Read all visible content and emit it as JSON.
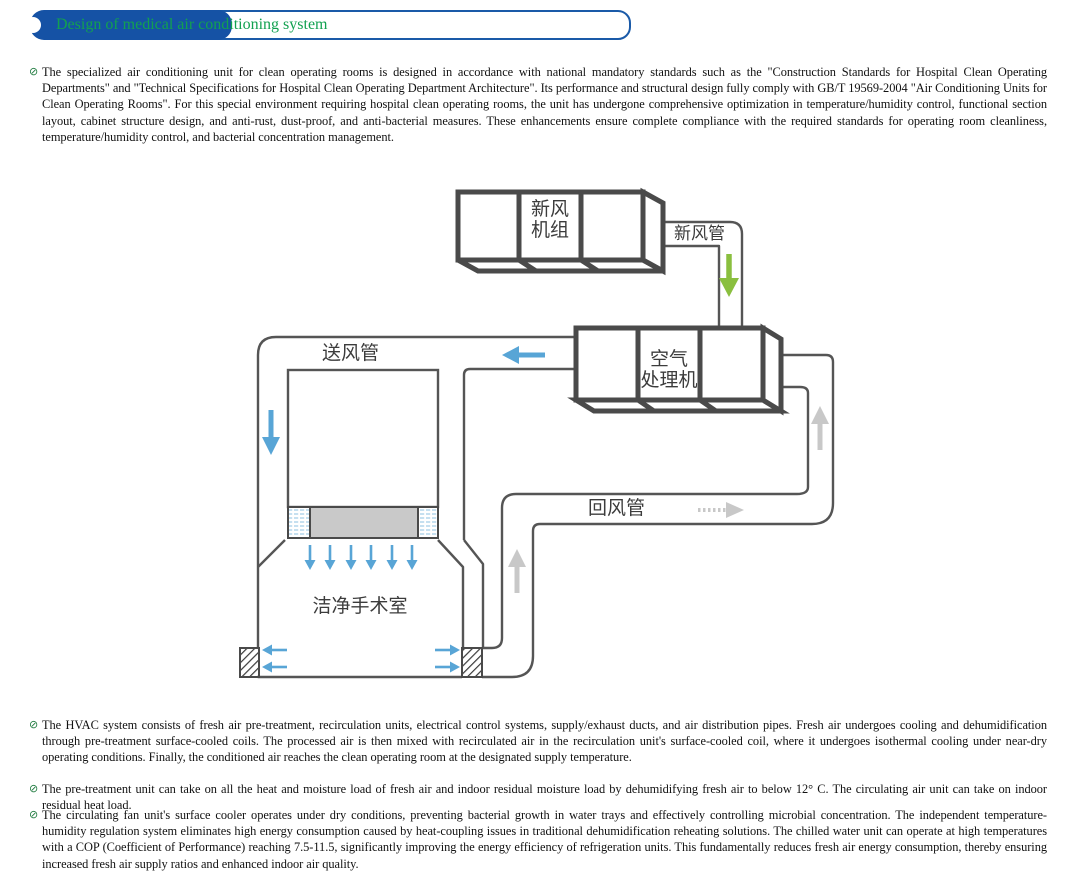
{
  "banner": {
    "title": "Design of medical air conditioning system"
  },
  "bullet_glyph": "⊘",
  "paragraphs": [
    {
      "text": "The specialized air conditioning unit for clean operating rooms is designed in accordance with national mandatory standards such as the \"Construction Standards for Hospital Clean Operating Departments\" and \"Technical Specifications for Hospital Clean Operating Department Architecture\". Its performance and structural design fully comply with GB/T 19569-2004 \"Air Conditioning Units for Clean Operating Rooms\". For this special environment requiring hospital clean operating rooms, the unit has undergone comprehensive optimization in temperature/humidity control, functional section layout, cabinet structure design, and anti-rust, dust-proof, and anti-bacterial measures. These enhancements ensure complete compliance with the required standards for operating room cleanliness, temperature/humidity control, and bacterial concentration management."
    },
    {
      "text": "The HVAC system consists of fresh air pre-treatment, recirculation units, electrical control systems, supply/exhaust ducts, and air distribution pipes. Fresh air undergoes cooling and dehumidification through pre-treatment surface-cooled coils. The processed air is then mixed with recirculated air in the recirculation unit's surface-cooled coil, where it undergoes isothermal cooling under near-dry operating conditions. Finally, the conditioned air reaches the clean operating room at the designated supply temperature."
    },
    {
      "text": "The pre-treatment unit can take on all the heat and moisture load of fresh air and indoor residual moisture load by dehumidifying fresh air to below 12° C. The circulating air unit can take on indoor residual heat load."
    },
    {
      "text": "The circulating fan unit's surface cooler operates under dry conditions, preventing bacterial growth in water trays and effectively controlling microbial concentration. The independent temperature-humidity regulation system eliminates high energy consumption caused by heat-coupling issues in traditional dehumidification reheating solutions. The chilled water unit can operate at high temperatures with a COP (Coefficient of Performance) reaching 7.5-11.5, significantly improving the energy efficiency of refrigeration units. This fundamentally reduces fresh air energy consumption, thereby ensuring increased fresh air supply ratios and enhanced indoor air quality."
    }
  ],
  "diagram": {
    "labels": {
      "fresh_air_unit_line1": "新风",
      "fresh_air_unit_line2": "机组",
      "fresh_air_duct": "新风管",
      "air_handler_line1": "空气",
      "air_handler_line2": "处理机",
      "supply_duct": "送风管",
      "return_duct": "回风管",
      "operating_room": "洁净手术室"
    }
  },
  "colors": {
    "diagram_line": "#4a4a4a",
    "duct_line": "#555555",
    "arrow_blue": "#58a5d6",
    "arrow_green": "#8abf3f",
    "arrow_gray": "#c8c8c8",
    "filter_gray": "#c9c9c9",
    "banner_fill": "#1552a5",
    "banner_border": "#1a5aa8",
    "title_green": "#12a150",
    "bullet_green": "#1e7a3e",
    "body_text": "#111111",
    "label_text": "#3c3c3c"
  }
}
